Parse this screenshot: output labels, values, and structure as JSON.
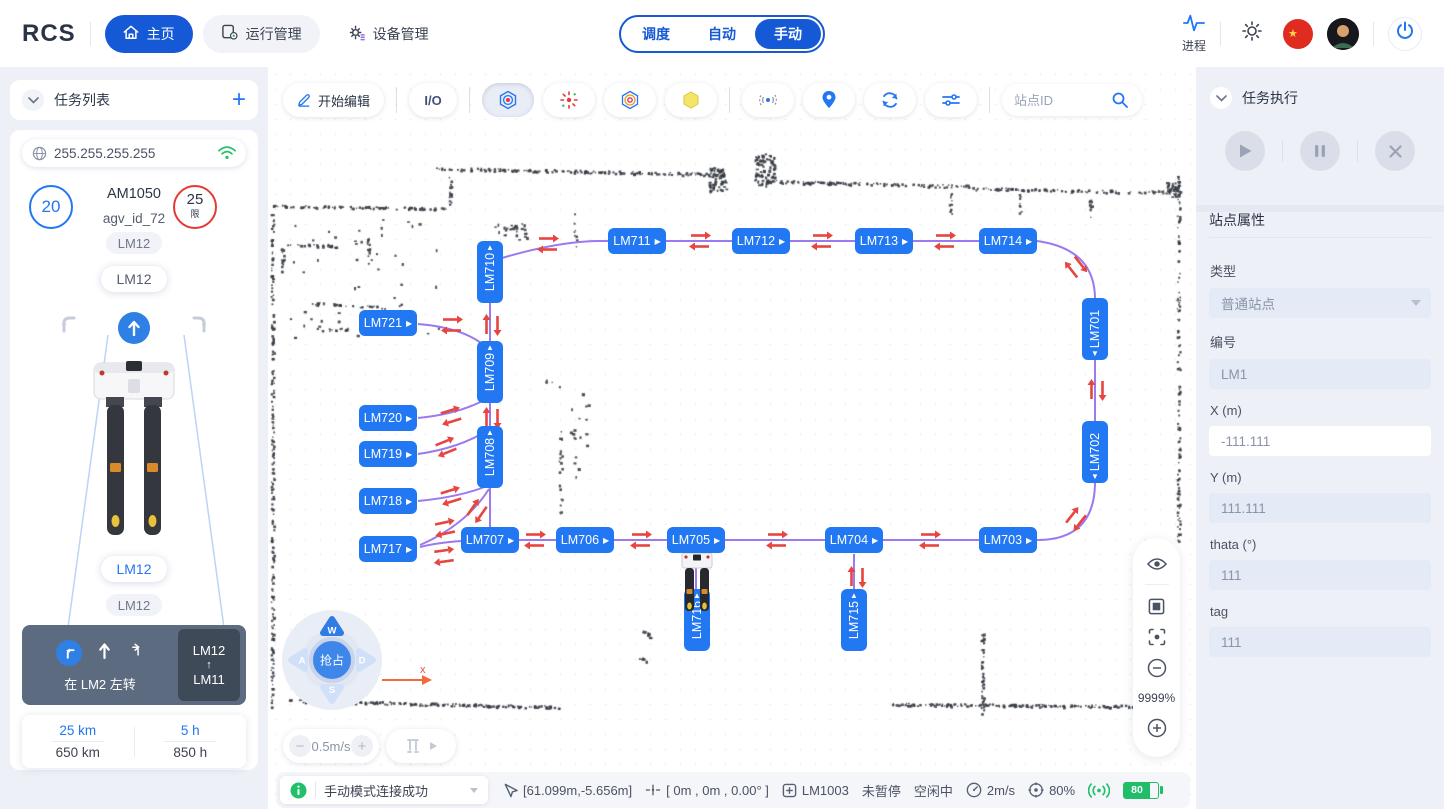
{
  "navbar": {
    "logo": "RCS",
    "items": [
      {
        "label": "主页",
        "active": true
      },
      {
        "label": "运行管理",
        "active": false
      },
      {
        "label": "设备管理",
        "active": false
      }
    ],
    "modes": [
      {
        "label": "调度",
        "active": false
      },
      {
        "label": "自动",
        "active": false
      },
      {
        "label": "手动",
        "active": true
      }
    ],
    "process_label": "进程"
  },
  "left_panel": {
    "title": "任务列表",
    "ip": "255.255.255.255",
    "speed_circle": "20",
    "vehicle_model": "AM1050",
    "vehicle_id": "agv_id_72",
    "limit_value": "25",
    "limit_label": "限",
    "tag_small_top": "LM12",
    "tag_large_top": "LM12",
    "tag_large_bottom": "LM12",
    "tag_small_bottom": "LM12",
    "instruction_text": "在 LM2 左转",
    "route_from": "LM12",
    "route_arrow": "↑",
    "route_to": "LM11",
    "stats": [
      {
        "value": "25 km",
        "total": "650 km"
      },
      {
        "value": "5 h",
        "total": "850 h"
      }
    ]
  },
  "toolbar": {
    "edit_label": "开始编辑",
    "io_label": "I/O",
    "search_placeholder": "站点ID"
  },
  "map": {
    "zoom_level": "9999%",
    "axis_label": "x",
    "joystick": {
      "center_label": "抢占",
      "up": "W",
      "left": "A",
      "down": "S",
      "right": "D"
    },
    "speed_label": "0.5m/s",
    "stations": [
      {
        "id": "LM710",
        "x": 222,
        "y": 205,
        "o": "v",
        "tri": "up"
      },
      {
        "id": "LM711",
        "x": 369,
        "y": 174,
        "o": "h"
      },
      {
        "id": "LM712",
        "x": 493,
        "y": 174,
        "o": "h"
      },
      {
        "id": "LM713",
        "x": 616,
        "y": 174,
        "o": "h"
      },
      {
        "id": "LM714",
        "x": 740,
        "y": 174,
        "o": "h"
      },
      {
        "id": "LM701",
        "x": 827,
        "y": 262,
        "o": "v",
        "tri": "down"
      },
      {
        "id": "LM702",
        "x": 827,
        "y": 385,
        "o": "v",
        "tri": "down"
      },
      {
        "id": "LM703",
        "x": 740,
        "y": 473,
        "o": "h"
      },
      {
        "id": "LM704",
        "x": 586,
        "y": 473,
        "o": "h"
      },
      {
        "id": "LM705",
        "x": 428,
        "y": 473,
        "o": "h"
      },
      {
        "id": "LM706",
        "x": 317,
        "y": 473,
        "o": "h"
      },
      {
        "id": "LM707",
        "x": 222,
        "y": 473,
        "o": "h"
      },
      {
        "id": "LM717",
        "x": 120,
        "y": 482,
        "o": "h"
      },
      {
        "id": "LM718",
        "x": 120,
        "y": 434,
        "o": "h"
      },
      {
        "id": "LM719",
        "x": 120,
        "y": 387,
        "o": "h"
      },
      {
        "id": "LM720",
        "x": 120,
        "y": 351,
        "o": "h"
      },
      {
        "id": "LM721",
        "x": 120,
        "y": 256,
        "o": "h"
      },
      {
        "id": "LM709",
        "x": 222,
        "y": 305,
        "o": "v",
        "tri": "up"
      },
      {
        "id": "LM708",
        "x": 222,
        "y": 390,
        "o": "v",
        "tri": "up"
      },
      {
        "id": "LM716",
        "x": 429,
        "y": 553,
        "o": "v",
        "tri": "up"
      },
      {
        "id": "LM715",
        "x": 586,
        "y": 553,
        "o": "v",
        "tri": "up"
      }
    ],
    "paths": [
      "M234,191 Q292,174 332,174 L769,174",
      "M769,174 Q827,182 827,232",
      "M827,292 L827,355",
      "M827,415 Q827,473 769,473",
      "M769,473 L224,473 Q180,473 152,480",
      "M222,236 L222,460",
      "M221,422 Q198,458 152,478",
      "M150,257 Q200,261 221,283",
      "M150,351 Q192,347 220,331",
      "M150,387 Q192,381 220,363",
      "M150,434 Q192,430 219,419",
      "M428,487 L428,525",
      "M586,487 L586,525"
    ],
    "arrow_pairs": [
      {
        "x": 280,
        "y": 177,
        "a": 0
      },
      {
        "x": 432,
        "y": 174,
        "a": 0
      },
      {
        "x": 554,
        "y": 174,
        "a": 0
      },
      {
        "x": 677,
        "y": 174,
        "a": 0
      },
      {
        "x": 808,
        "y": 200,
        "a": 52
      },
      {
        "x": 829,
        "y": 323,
        "a": 90
      },
      {
        "x": 808,
        "y": 452,
        "a": 128
      },
      {
        "x": 662,
        "y": 473,
        "a": 0
      },
      {
        "x": 509,
        "y": 473,
        "a": 0
      },
      {
        "x": 373,
        "y": 473,
        "a": 0
      },
      {
        "x": 267,
        "y": 473,
        "a": 0
      },
      {
        "x": 589,
        "y": 510,
        "a": 90
      },
      {
        "x": 224,
        "y": 258,
        "a": 90
      },
      {
        "x": 224,
        "y": 351,
        "a": 90
      },
      {
        "x": 184,
        "y": 258,
        "a": 0
      },
      {
        "x": 183,
        "y": 349,
        "a": -17
      },
      {
        "x": 178,
        "y": 380,
        "a": -22
      },
      {
        "x": 183,
        "y": 429,
        "a": -17
      },
      {
        "x": 209,
        "y": 444,
        "a": -55
      },
      {
        "x": 177,
        "y": 461,
        "a": -12
      },
      {
        "x": 176,
        "y": 489,
        "a": -8
      }
    ]
  },
  "status_bar": {
    "message": "手动模式连接成功",
    "coords": "[61.099m,-5.656m]",
    "pose": "[ 0m , 0m , 0.00° ]",
    "station": "LM1003",
    "pause_state": "未暂停",
    "run_state": "空闲中",
    "speed": "2m/s",
    "percent": "80%",
    "battery": "80"
  },
  "right_panel": {
    "exec_title": "任务执行",
    "props_title": "站点属性",
    "fields": [
      {
        "label": "类型",
        "value": "普通站点",
        "kind": "select"
      },
      {
        "label": "编号",
        "value": "LM1",
        "kind": "input"
      },
      {
        "label": "X (m)",
        "value": "-111.111",
        "kind": "plain"
      },
      {
        "label": "Y (m)",
        "value": "111.111",
        "kind": "input"
      },
      {
        "label": "thata (°)",
        "value": "111",
        "kind": "input"
      },
      {
        "label": "tag",
        "value": "111",
        "kind": "input"
      }
    ]
  }
}
